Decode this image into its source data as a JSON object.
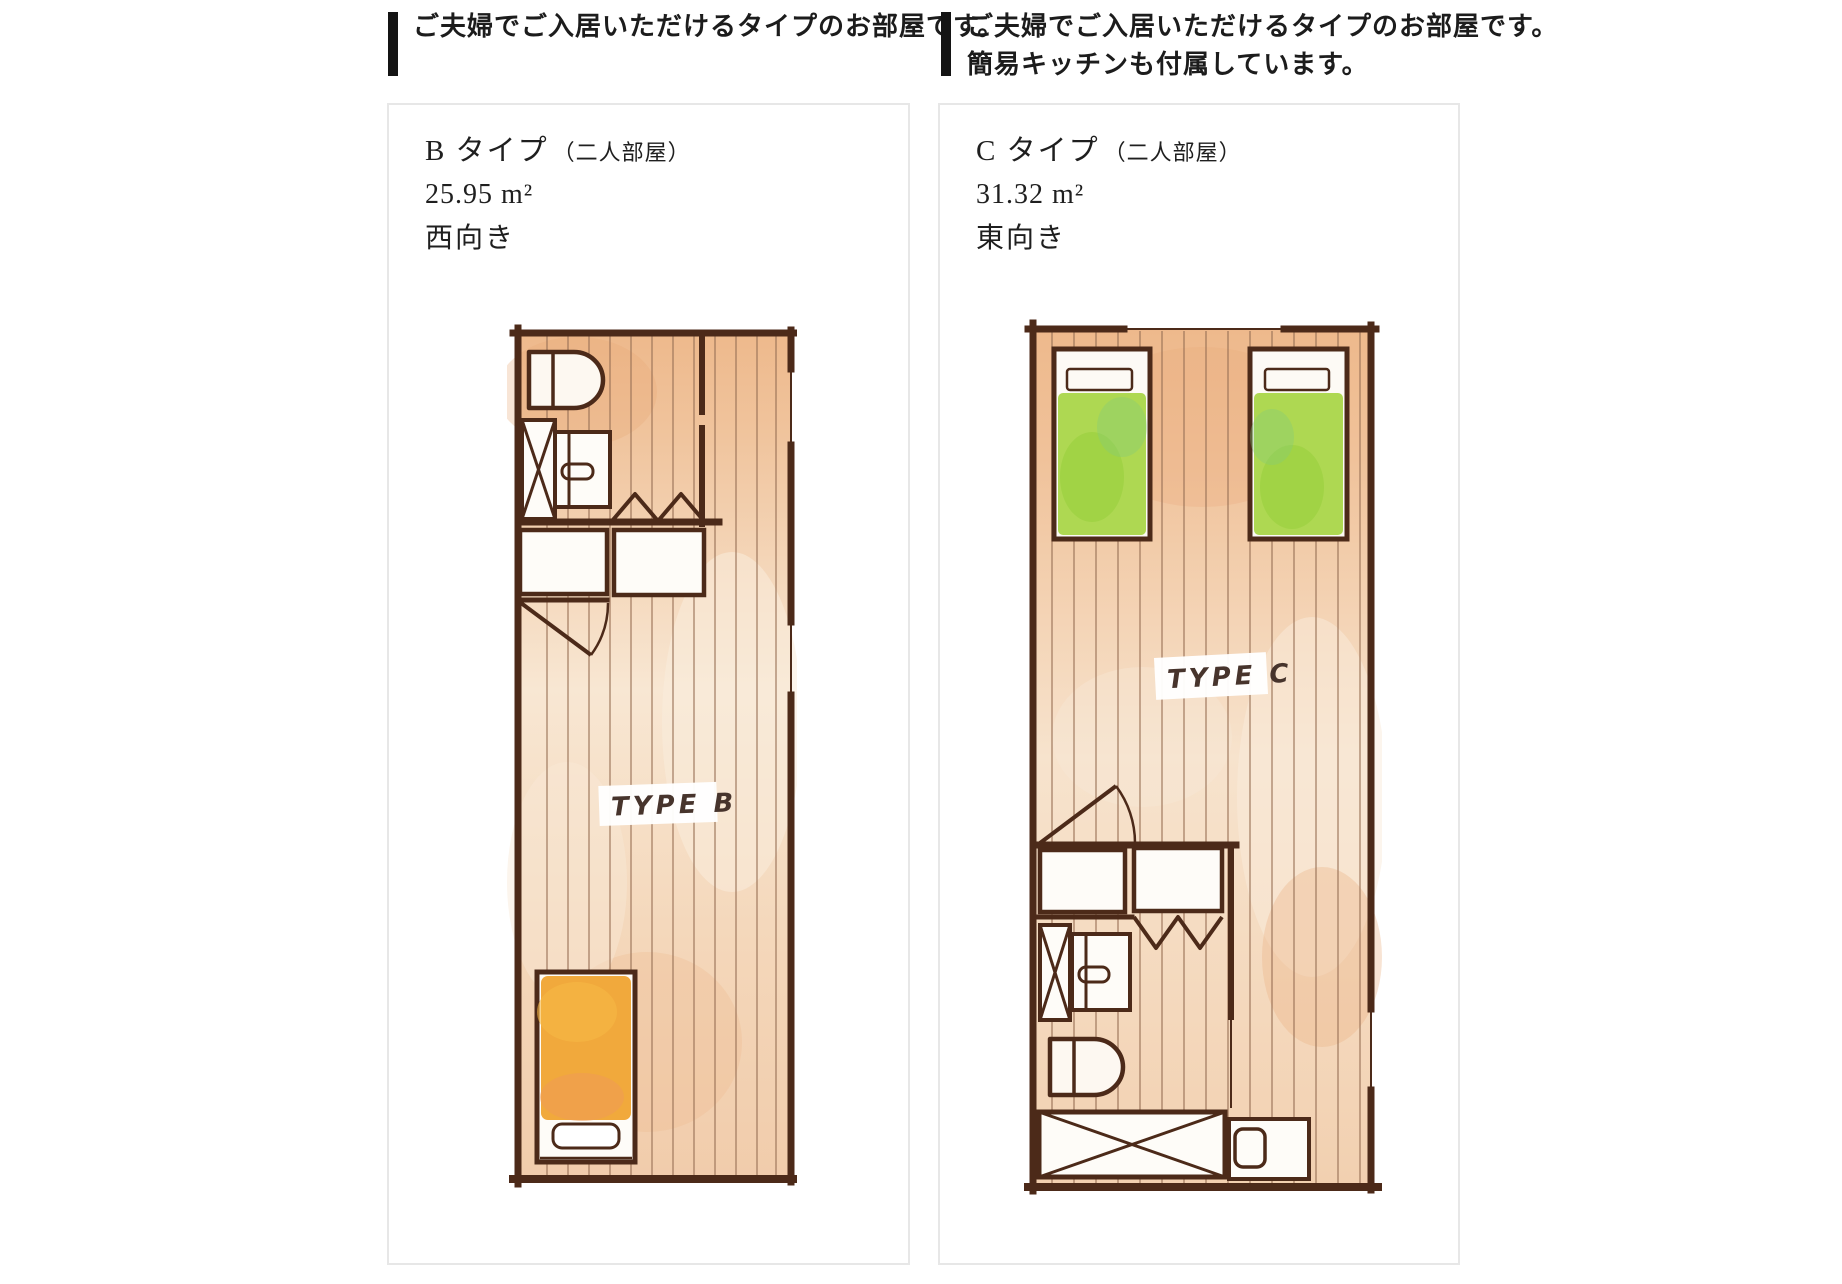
{
  "headers": {
    "left": {
      "lines": [
        "ご夫婦でご入居いただけるタイプのお部屋です。"
      ]
    },
    "right": {
      "lines": [
        "ご夫婦でご入居いただけるタイプのお部屋です。",
        "簡易キッチンも付属しています。"
      ]
    }
  },
  "panels": [
    {
      "type_label": "B タイプ",
      "occupancy_note": "（二人部屋）",
      "area": "25.95 m²",
      "facing": "西向き",
      "plan_label": "TYPE B"
    },
    {
      "type_label": "C タイプ",
      "occupancy_note": "（二人部屋）",
      "area": "31.32 m²",
      "facing": "東向き",
      "plan_label": "TYPE C"
    }
  ],
  "colors": {
    "accent_bar": "#141414",
    "text": "#1f1f1f",
    "panel_border": "#e7e7e7",
    "wall_brown": "#4c2a19",
    "plank_line": "#9a7257",
    "floor_top": "#eeb98c",
    "floor_mid": "#f8e7d3",
    "floor_bottom": "#f1ccab",
    "bed_green": "#aed852",
    "bed_orange": "#f1a93c",
    "label_ink": "#47342c"
  }
}
